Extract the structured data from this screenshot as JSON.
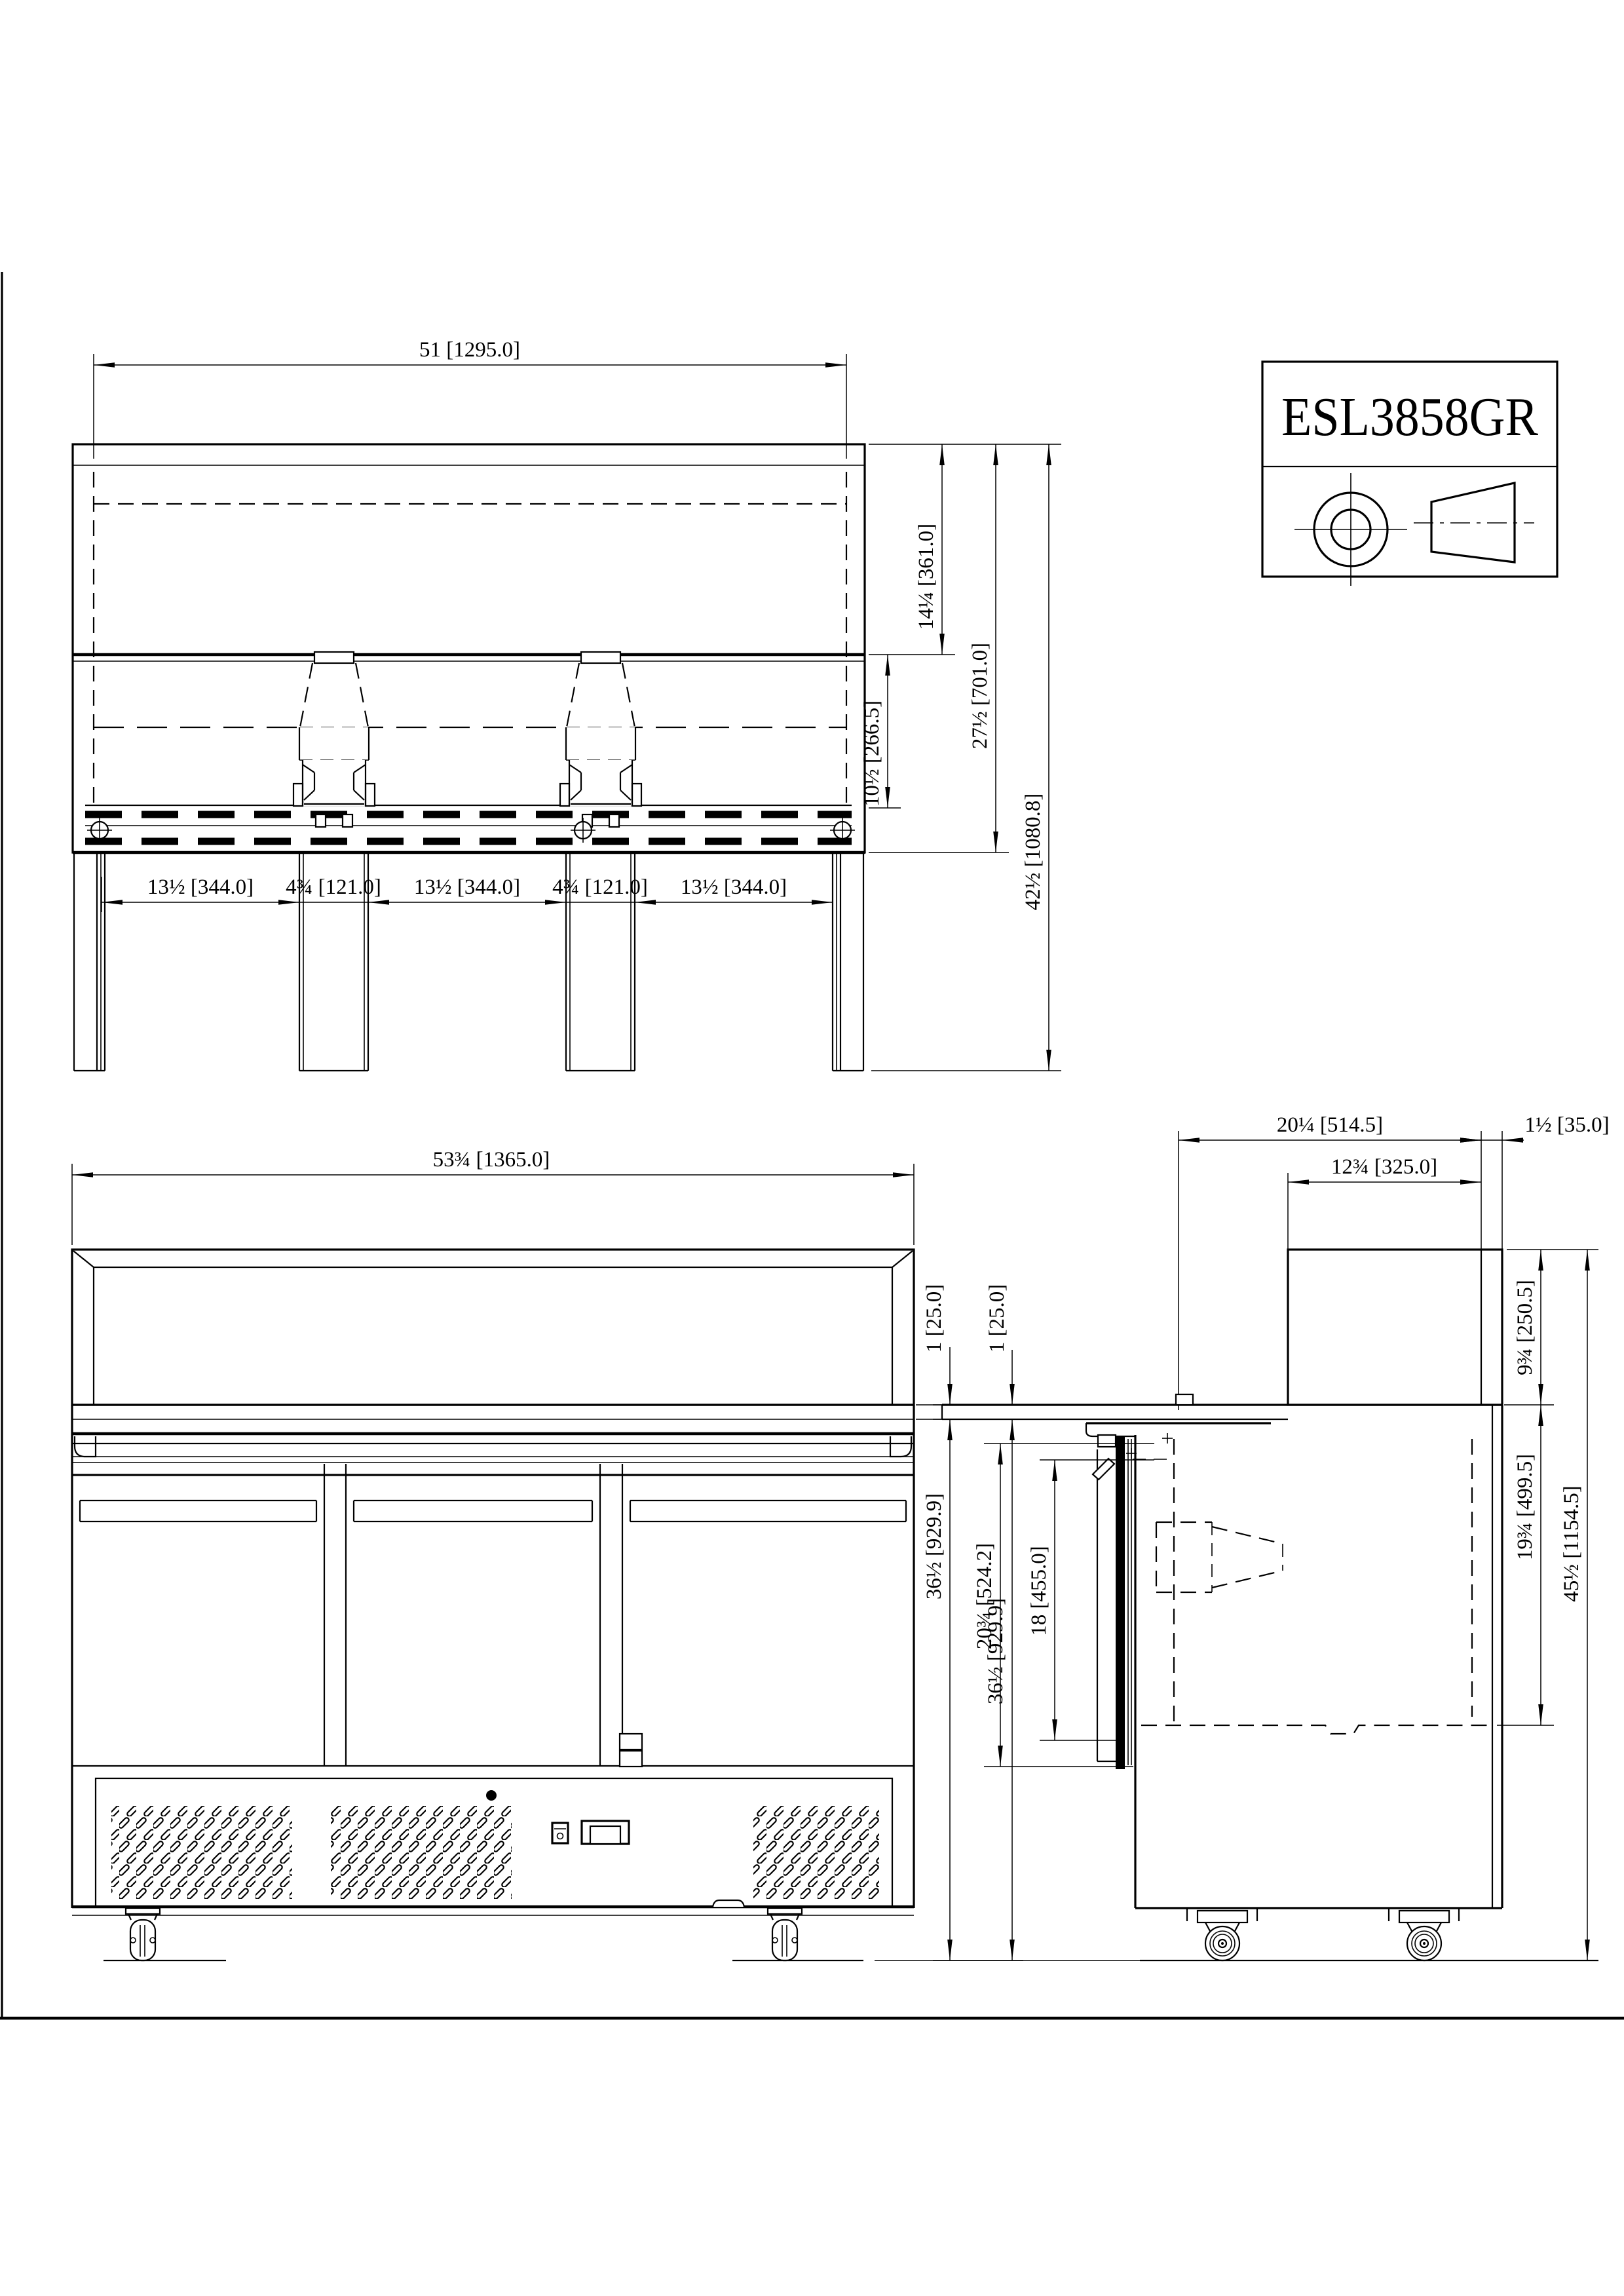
{
  "title_block": {
    "model": "ESL3858GR"
  },
  "top_view": {
    "width": "51 [1295.0]",
    "glass_depth": "14¼ [361.0]",
    "hood_depth": "27½ [701.0]",
    "nozzle_depth": "10½ [266.5]",
    "overall_depth": "42½ [1080.8]",
    "spacings": [
      "13½ [344.0]",
      "4¾ [121.0]",
      "13½ [344.0]",
      "4¾ [121.0]",
      "13½ [344.0]"
    ]
  },
  "front_view": {
    "overall_width": "53¾ [1365.0]",
    "counter_thickness": "1 [25.0]",
    "counter_height": "36½ [929.9]"
  },
  "side_view": {
    "top_depth": "20¼ [514.5]",
    "back_wall": "1½ [35.0]",
    "glass_box_depth": "12¾ [325.0]",
    "counter_thickness": "1 [25.0]",
    "counter_height": "36½ [929.9]",
    "door_opening": "20¾ [524.2]",
    "inner_opening": "18 [455.0]",
    "glass_box_height": "9¾ [250.5]",
    "interior_depth": "19¾ [499.5]",
    "overall_height": "45½ [1154.5]"
  }
}
